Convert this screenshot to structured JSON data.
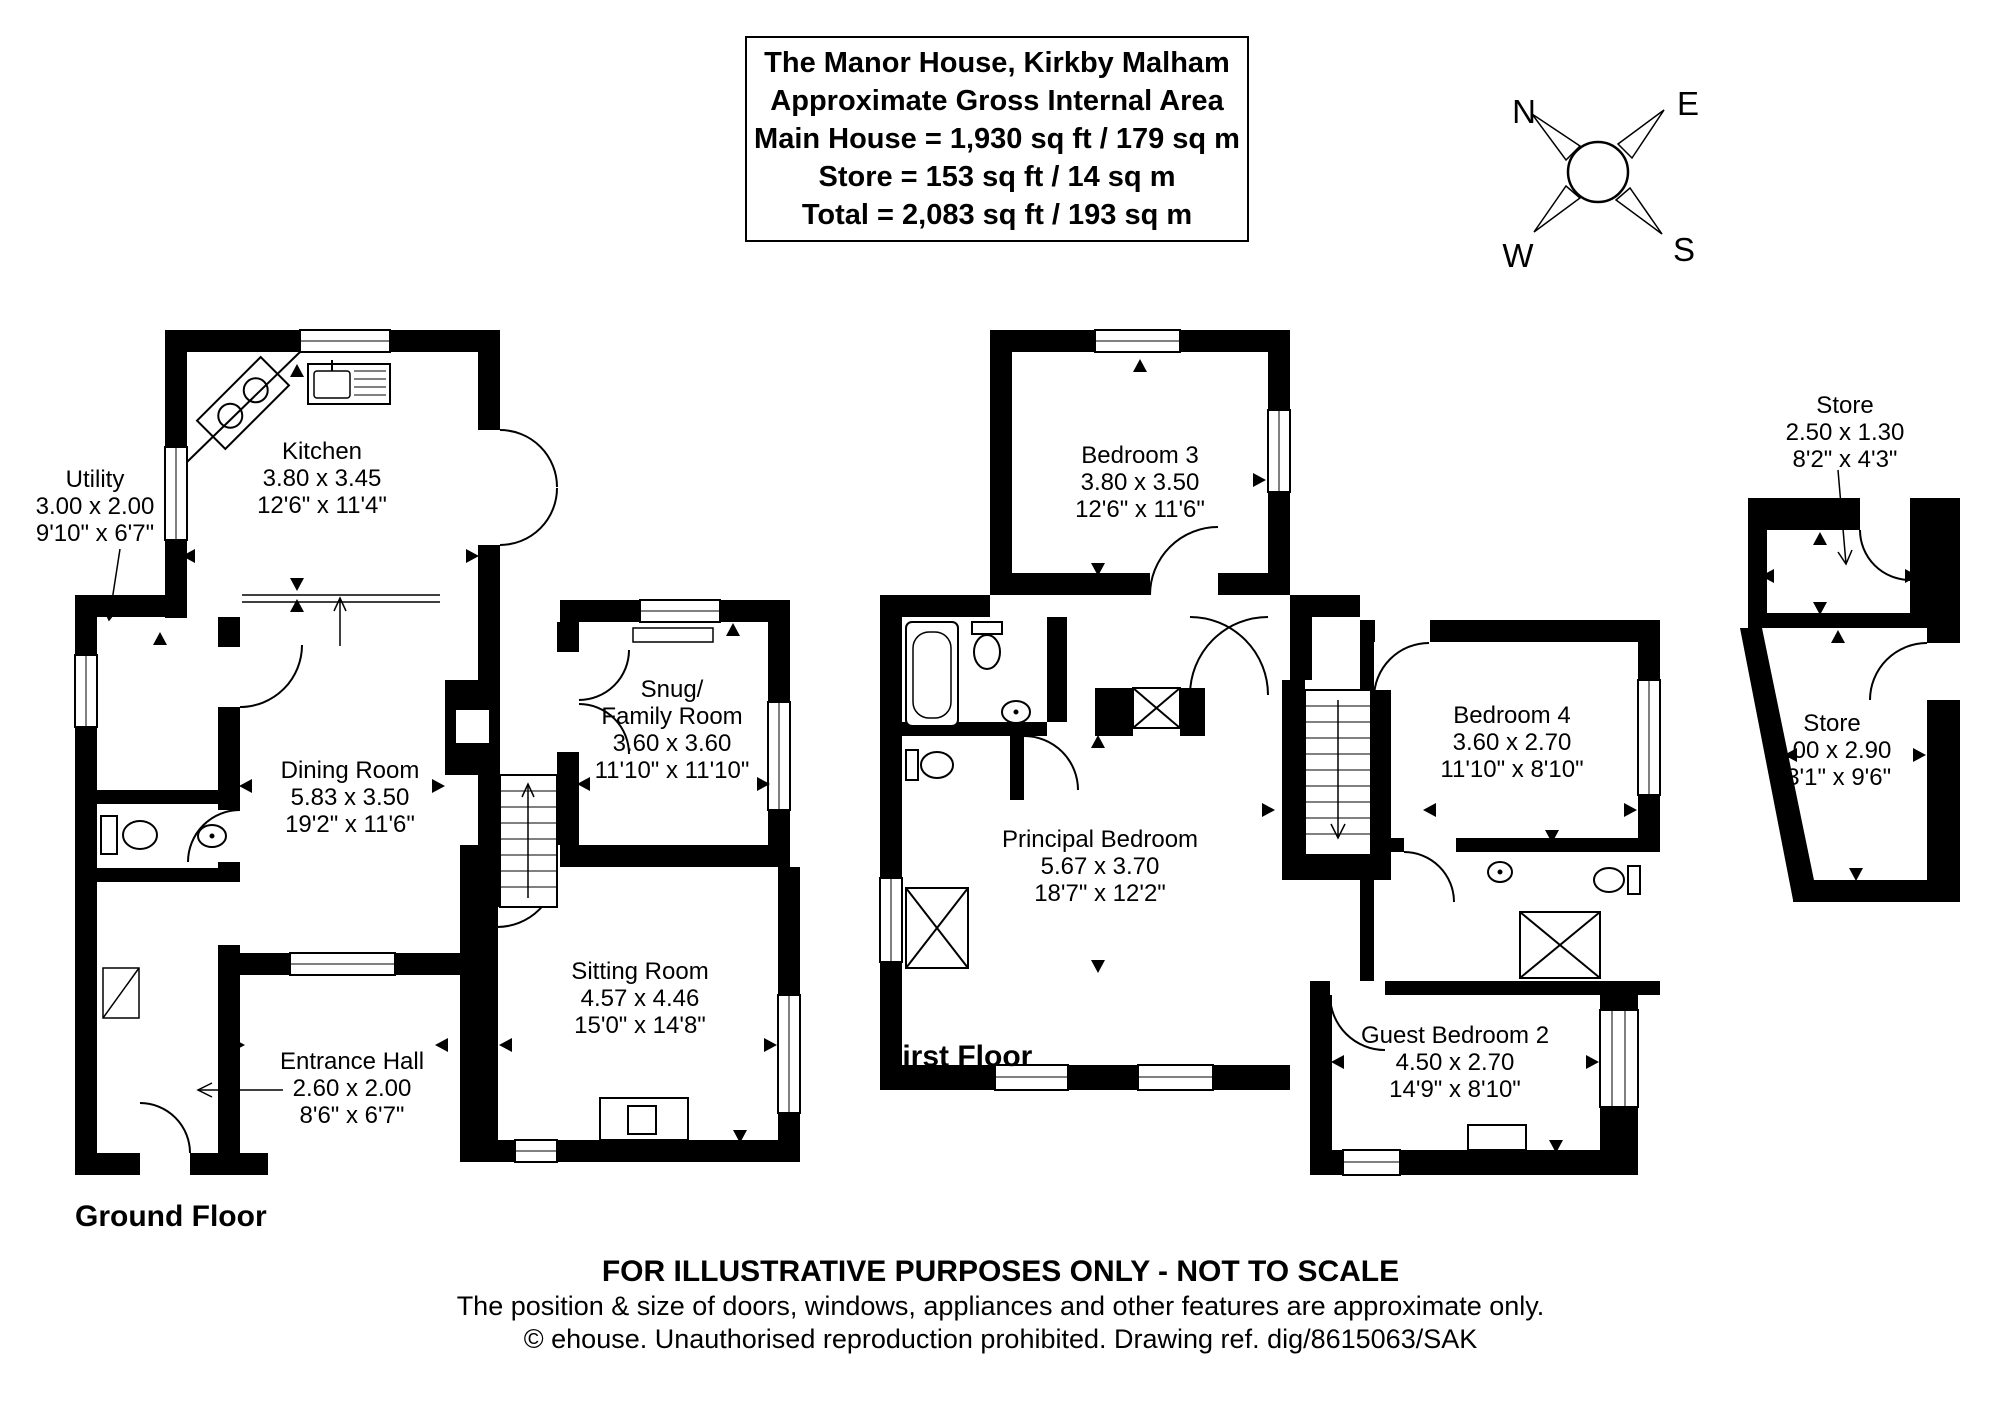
{
  "title_box": {
    "line1": "The Manor House, Kirkby Malham",
    "line2": "Approximate Gross Internal Area",
    "line3": "Main House = 1,930 sq ft / 179 sq m",
    "line4": "Store = 153 sq ft / 14 sq m",
    "line5": "Total = 2,083 sq ft / 193 sq m"
  },
  "compass": {
    "north": "N",
    "east": "E",
    "south": "S",
    "west": "W"
  },
  "floor_labels": {
    "ground": "Ground Floor",
    "first": "First Floor"
  },
  "rooms": {
    "kitchen": {
      "name": "Kitchen",
      "metric": "3.80 x 3.45",
      "imperial": "12'6\" x 11'4\""
    },
    "utility": {
      "name": "Utility",
      "metric": "3.00 x 2.00",
      "imperial": "9'10\" x 6'7\""
    },
    "dining_room": {
      "name": "Dining Room",
      "metric": "5.83 x 3.50",
      "imperial": "19'2\" x 11'6\""
    },
    "snug": {
      "name": "Snug/",
      "name2": "Family Room",
      "metric": "3.60 x 3.60",
      "imperial": "11'10\" x 11'10\""
    },
    "sitting_room": {
      "name": "Sitting Room",
      "metric": "4.57 x 4.46",
      "imperial": "15'0\" x 14'8\""
    },
    "entrance_hall": {
      "name": "Entrance Hall",
      "metric": "2.60 x 2.00",
      "imperial": "8'6\" x 6'7\""
    },
    "bedroom3": {
      "name": "Bedroom 3",
      "metric": "3.80 x 3.50",
      "imperial": "12'6\" x 11'6\""
    },
    "principal_bedroom": {
      "name": "Principal Bedroom",
      "metric": "5.67 x 3.70",
      "imperial": "18'7\" x 12'2\""
    },
    "bedroom4": {
      "name": "Bedroom 4",
      "metric": "3.60 x 2.70",
      "imperial": "11'10\" x 8'10\""
    },
    "guest_bedroom2": {
      "name": "Guest Bedroom 2",
      "metric": "4.50 x 2.70",
      "imperial": "14'9\" x 8'10\""
    },
    "store_upper": {
      "name": "Store",
      "metric": "2.50 x 1.30",
      "imperial": "8'2\" x 4'3\""
    },
    "store_lower": {
      "name": "Store",
      "metric": "4.00 x 2.90",
      "imperial": "13'1\" x 9'6\""
    }
  },
  "footer": {
    "line1": "FOR ILLUSTRATIVE PURPOSES ONLY - NOT TO SCALE",
    "line2": "The position & size of doors, windows, appliances and other features are approximate only.",
    "line3": "© ehouse. Unauthorised reproduction prohibited. Drawing ref. dig/8615063/SAK"
  },
  "colors": {
    "walls": "#000000",
    "background": "#ffffff"
  }
}
